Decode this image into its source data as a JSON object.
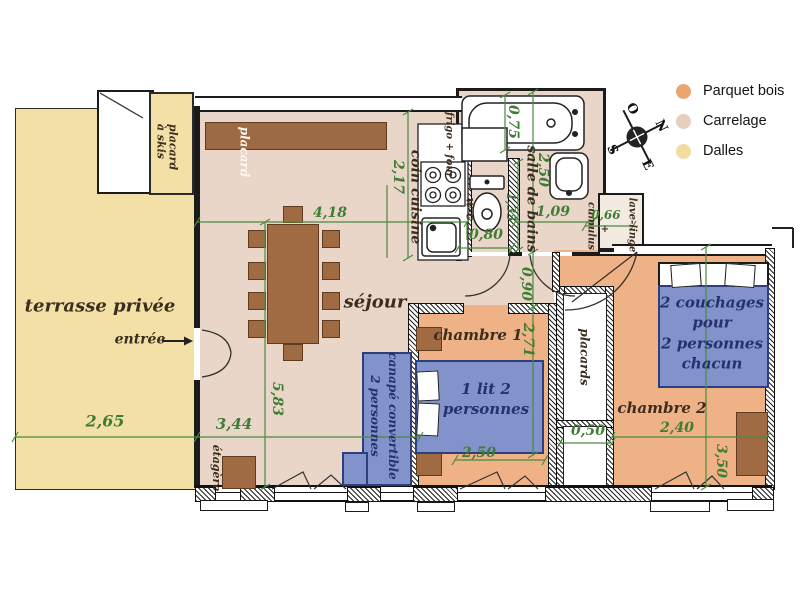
{
  "legend": {
    "items": [
      {
        "label": "Parquet bois",
        "color": "#eaa571"
      },
      {
        "label": "Carrelage",
        "color": "#e7cfc0"
      },
      {
        "label": "Dalles",
        "color": "#f2dc9f"
      }
    ]
  },
  "compass": {
    "n": "N",
    "e": "E",
    "s": "S",
    "o": "O"
  },
  "rooms": {
    "terrasse": "terrasse privée",
    "entree": "entrée",
    "sejour": "séjour",
    "cuisine": "coin cuisine",
    "frigo_four": "frigo + four",
    "wc": "w-c",
    "salle_de_bains": "salle de bains",
    "chambre1": "chambre 1",
    "chambre2": "chambre 2",
    "placard": "placard",
    "placard_skis_1": "placard",
    "placard_skis_2": "à skis",
    "placards": "placards",
    "etagere": "étagère",
    "lave_linge": "lave-linge",
    "plus": "+",
    "cumulus": "cumulus"
  },
  "furniture": {
    "lit_1": "1 lit 2",
    "lit_2": "personnes",
    "canape_1": "canapé convertible",
    "canape_2": "2 personnes",
    "couchages": [
      "2 couchages",
      "pour",
      "2 personnes",
      "chacun"
    ]
  },
  "dims": {
    "sejour_w": "4,18",
    "cuisine_h": "2,17",
    "sejour_h": "5,83",
    "terrasse_w": "2,65",
    "sejour_part": "3,44",
    "tub": "0,75",
    "bain_h": "2,50",
    "wc_h": "1,35",
    "wc_w": "0,80",
    "bain_w": "1,09",
    "lave": "0,66",
    "hall": "0,90",
    "ch1_h": "2,71",
    "lit_w": "2,50",
    "niche": "0,50",
    "ch2_w": "2,40",
    "ch2_h": "3,50"
  }
}
